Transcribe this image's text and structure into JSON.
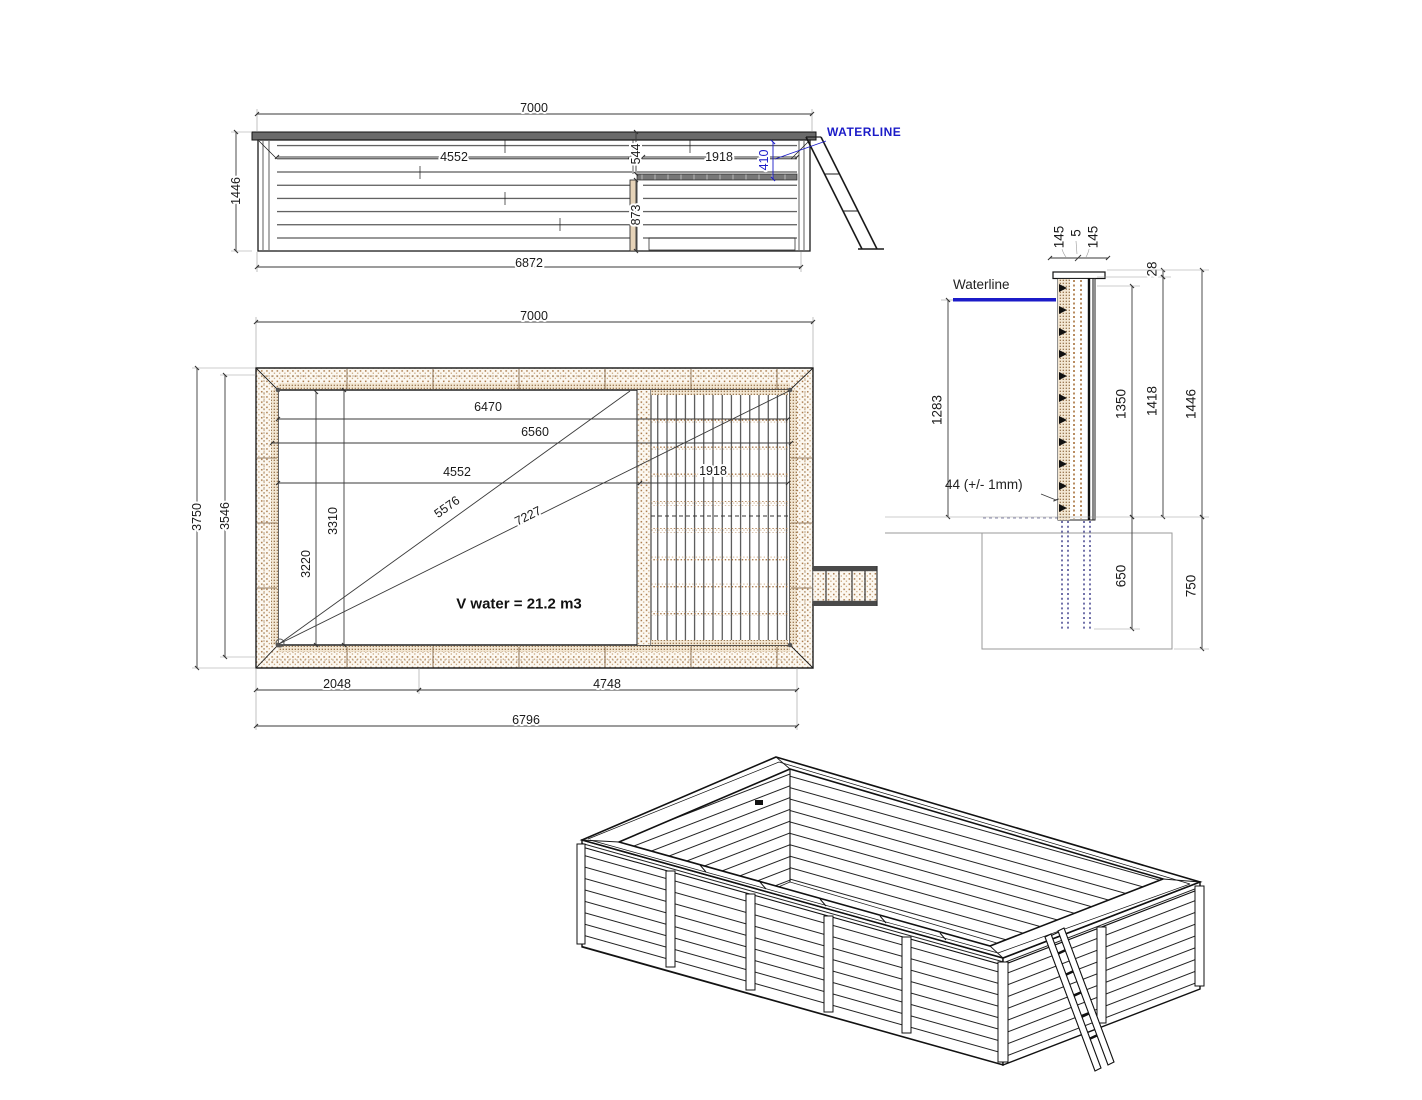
{
  "colors": {
    "accent_blue": "#1b1bc8",
    "wood_hatch": "#a87848"
  },
  "elevation": {
    "waterline_label": "WATERLINE",
    "dims": {
      "top": "7000",
      "left": "1446",
      "bottom": "6872",
      "inner": "4552",
      "deck": "1918",
      "upper": "544",
      "lower": "873",
      "water": "410"
    }
  },
  "plan": {
    "volume_label": "V water = 21.2 m3",
    "dims": {
      "top": "7000",
      "side_outer": "3750",
      "side_inner": "3546",
      "len1": "6470",
      "len2": "6560",
      "len3": "4552",
      "deck": "1918",
      "diag_short": "5576",
      "diag_long": "7227",
      "vert1": "3310",
      "vert2": "3220",
      "bottom1": "2048",
      "bottom2": "4748",
      "bottom3": "6796"
    }
  },
  "section": {
    "waterline_label": "Waterline",
    "base_note": "44 (+/- 1mm)",
    "dims": {
      "wall_out": "145",
      "gap": "5",
      "wall_in": "145",
      "top_offset": "28",
      "waterline_depth": "1283",
      "height1": "1350",
      "height2": "1418",
      "height3": "1446",
      "post_embed": "650",
      "pit_depth": "750"
    }
  }
}
